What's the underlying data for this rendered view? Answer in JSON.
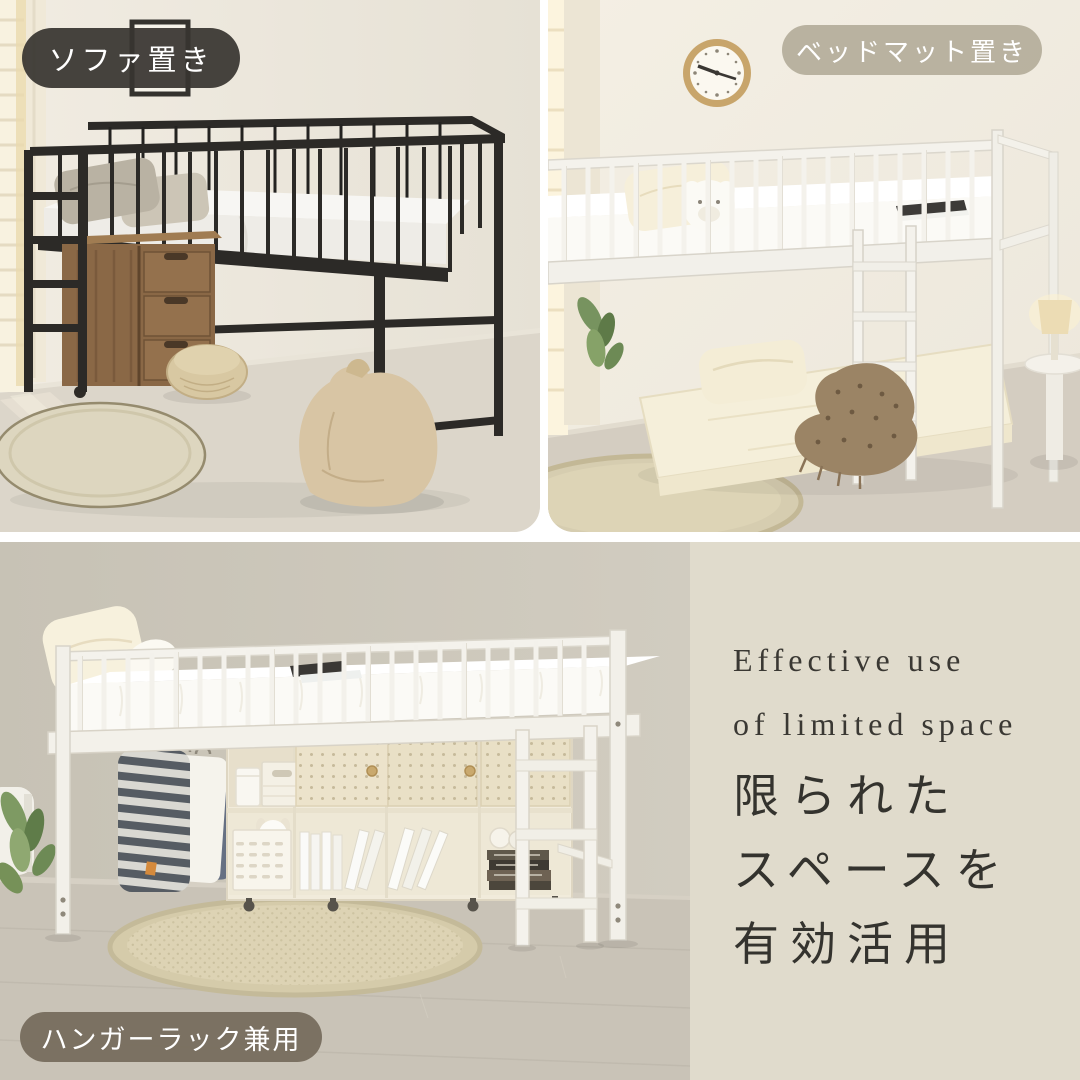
{
  "badges": {
    "sofa": {
      "label": "ソファ置き",
      "bg": "#383530"
    },
    "bedmat": {
      "label": "ベッドマット置き",
      "bg": "#b0aa96"
    },
    "hanger": {
      "label": "ハンガーラック兼用",
      "bg": "#776d5d"
    }
  },
  "panel": {
    "bg": "#e0dbcc",
    "text_color": "#3a3833",
    "heading_en": {
      "line1": "Effective use",
      "line2": "of limited space"
    },
    "heading_jp": {
      "line1": "限られた",
      "line2": "スペースを",
      "line3": "有効活用"
    }
  },
  "palette": {
    "black_bed": "#2c2a27",
    "white_bed": "#f4f2ec",
    "wall_cream": "#eae5da",
    "wall_gray": "#cbc6ba",
    "rug": "#ddd6bf",
    "wood_cabinet": "#8a6846",
    "divider": "#ffffff"
  }
}
